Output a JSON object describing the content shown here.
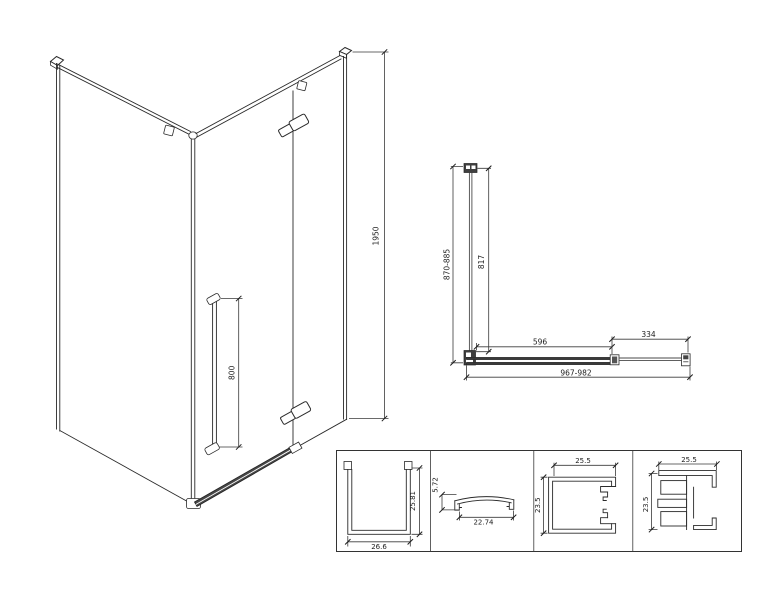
{
  "colors": {
    "background": "#ffffff",
    "line": "#2a2a2a",
    "dark_fill": "#3f3f3f"
  },
  "isometric_view": {
    "height_mm": "1950",
    "handle_length_mm": "800"
  },
  "plan_view": {
    "depth_range_mm": "870-885",
    "side_glass_mm": "817",
    "door_mm": "596",
    "fixed_panel_mm": "334",
    "width_range_mm": "967-982"
  },
  "profile_sections": [
    {
      "id": "wall-channel-profile",
      "height": "25.81",
      "width": "26.6"
    },
    {
      "id": "cover-cap-profile",
      "height": "5.72",
      "width": "22.74"
    },
    {
      "id": "glass-clamp-profile",
      "width": "25.5",
      "height": "23.5"
    },
    {
      "id": "wall-bracket-profile",
      "width": "25.5",
      "height": "23.5"
    }
  ]
}
